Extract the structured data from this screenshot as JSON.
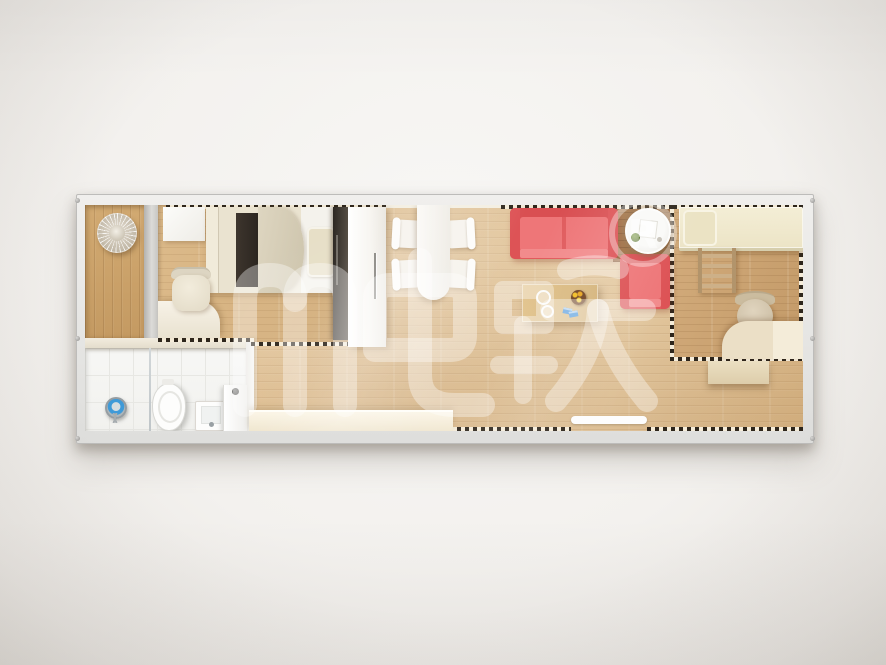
{
  "meta": {
    "type": "3d-floor-plan-render",
    "scene": "container-home-top-down-view"
  },
  "watermark": {
    "text": "肥跃",
    "registered_letter": "R",
    "registered_symbol": "®",
    "color": "#ffffff"
  },
  "unit": {
    "frame_color": "#e2e1df",
    "rooms": [
      {
        "id": "entry",
        "label": "entry nook",
        "floor_color": "#c9a066",
        "furniture": [
          {
            "name": "pendant-lamp"
          }
        ]
      },
      {
        "id": "bedroom-1",
        "label": "bedroom 1",
        "floor_color": "#d9b888",
        "furniture": [
          {
            "name": "storage-cabinet"
          },
          {
            "name": "double-bed"
          },
          {
            "name": "bed-runner",
            "color": "#38302a"
          },
          {
            "name": "duvet"
          },
          {
            "name": "pillow"
          },
          {
            "name": "desk"
          },
          {
            "name": "desk-chair"
          },
          {
            "name": "dark-wardrobe"
          }
        ]
      },
      {
        "id": "bathroom",
        "label": "bathroom",
        "floor_color": "#f6f6f4",
        "furniture": [
          {
            "name": "shower-drain"
          },
          {
            "name": "glass-partition"
          },
          {
            "name": "toilet"
          },
          {
            "name": "wash-basin"
          },
          {
            "name": "washing-machine"
          }
        ]
      },
      {
        "id": "living-dining",
        "label": "living / dining",
        "floor_color": "#dfc096",
        "furniture": [
          {
            "name": "tall-cabinet"
          },
          {
            "name": "dining-table"
          },
          {
            "name": "dining-chair",
            "count": 4
          },
          {
            "name": "sofa",
            "color": "#e66567"
          },
          {
            "name": "armchair",
            "color": "#e66567"
          },
          {
            "name": "side-table"
          },
          {
            "name": "plant"
          },
          {
            "name": "coffee-table"
          },
          {
            "name": "fruit-bowl"
          },
          {
            "name": "kitchen-bench"
          },
          {
            "name": "door-threshold"
          }
        ]
      },
      {
        "id": "bedroom-2",
        "label": "bedroom 2",
        "floor_color": "#cfa877",
        "furniture": [
          {
            "name": "single-bed"
          },
          {
            "name": "pillow"
          },
          {
            "name": "bunk-ladder"
          },
          {
            "name": "office-chair"
          },
          {
            "name": "corner-desk"
          },
          {
            "name": "storage-shelf"
          }
        ]
      }
    ]
  },
  "palette": {
    "background": "#f3f1ee",
    "frame": "#e2e1df",
    "wood_light": "#dfc096",
    "wood_dark": "#c9a066",
    "wood_walnut": "#a97b4e",
    "sofa_red": "#e66567",
    "cream_furniture": "#efe5cf",
    "bath_white": "#f6f6f4"
  }
}
